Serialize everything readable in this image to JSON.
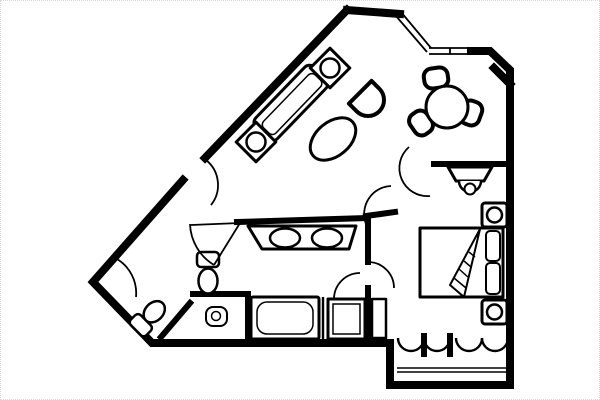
{
  "meta": {
    "title": "hotel-suite-floor-plan",
    "canvas": {
      "width": 600,
      "height": 400
    },
    "colors": {
      "background": "#ffffff",
      "ink": "#000000",
      "frame_dots": "#d8d8d8"
    }
  },
  "floorplan": {
    "walls_exterior": [
      "M 347 10 L 205 158",
      "M 183 180 L 93 282 L 152 343 L 390 343 L 390 385 L 510 385 L 510 70 L 490 51 L 471 51",
      "M 400 14 L 347 10",
      "M 494 68 L 510 84"
    ],
    "windows": [
      "M 401 12 L 431 48",
      "M 396 16 L 427 52",
      "M 429 48 L 472 48",
      "M 429 54 L 472 54",
      "M 450 48 L 450 54"
    ],
    "walls_interior": [
      "M 237 222 L 368 218 L 368 262",
      "M 366 216 L 395 212",
      "M 368 288 L 368 341",
      "M 248 295 L 248 341",
      "M 193 294 L 248 294",
      "M 190 303 L 161 337",
      "M 434 164 L 510 164",
      "M 424 336 L 424 354",
      "M 450 336 L 450 354"
    ],
    "walls_thin": [
      "M 323 297 L 323 341"
    ],
    "doors": [
      {
        "name": "entry-door-swing",
        "d": "M 206 160 A 32 32 0 0 1 211 205"
      },
      {
        "name": "bathroom-door-swing",
        "d": "M 190 224 A 50 50 0 0 0 214 265",
        "leaf": "M 240 223 L 191 225",
        "leaf2": "M 240 223 L 214 265"
      },
      {
        "name": "wc-door-swing",
        "d": "M 117 259 A 40 40 0 0 1 136 297"
      },
      {
        "name": "double-door-left-swing",
        "d": "M 366 224 A 28 28 0 0 1 391 186"
      },
      {
        "name": "double-door-right-swing",
        "d": "M 430 196 A 28 28 0 0 1 409 147"
      },
      {
        "name": "bedroom-bathroom-door-swing",
        "d": "M 368 262 A 26 26 0 0 1 394 288"
      },
      {
        "name": "shower-door-swing",
        "d": "M 334 299 A 26 26 0 0 1 360 273"
      },
      {
        "name": "closet-bifold-door-1",
        "d": "M 398 338 A 13 13 0 0 0 424 338",
        "cls": "wt"
      },
      {
        "name": "closet-bifold-door-2",
        "d": "M 424 338 A 13 13 0 0 0 450 338",
        "cls": "wt"
      },
      {
        "name": "closet-bifold-door-3",
        "d": "M 456 338 A 13 13 0 0 0 482 338",
        "cls": "wt"
      },
      {
        "name": "closet-bifold-door-4",
        "d": "M 482 338 A 13 13 0 0 0 508 338",
        "cls": "wt"
      }
    ],
    "furniture": [
      {
        "name": "sofa",
        "tf": "rotate(-46 291 103)",
        "shapes": [
          {
            "t": "rect",
            "x": 249,
            "y": 88,
            "width": 84,
            "height": 30,
            "rx": 7,
            "cls": "f3"
          },
          {
            "t": "rect",
            "x": 254,
            "y": 96,
            "width": 74,
            "height": 17,
            "rx": 5,
            "cls": "ln"
          }
        ]
      },
      {
        "name": "side-table-lamp",
        "tf": "rotate(45 330 68)",
        "shapes": [
          {
            "t": "rect",
            "x": 316,
            "y": 54,
            "width": 28,
            "height": 28,
            "cls": "f3"
          },
          {
            "t": "circle",
            "cx": 330,
            "cy": 68,
            "r": 9.5,
            "cls": "f25"
          }
        ]
      },
      {
        "name": "side-table-lamp",
        "tf": "rotate(45 256 142)",
        "shapes": [
          {
            "t": "rect",
            "x": 242,
            "y": 128,
            "width": 28,
            "height": 28,
            "cls": "f3"
          },
          {
            "t": "circle",
            "cx": 256,
            "cy": 142,
            "r": 9.5,
            "cls": "f25"
          }
        ]
      },
      {
        "name": "armchair",
        "tf": "translate(368 100) rotate(45)",
        "shapes": [
          {
            "t": "path",
            "d": "M -11 -16 L 0 -16 A 16 16 0 0 1 0 16 L -11 16 Z",
            "cls": "f4"
          }
        ]
      },
      {
        "name": "oval-table",
        "tf": "rotate(-40 333 139)",
        "shapes": [
          {
            "t": "ellipse",
            "cx": 333,
            "cy": 139,
            "rx": 26,
            "ry": 17,
            "cls": "f3"
          }
        ]
      },
      {
        "name": "dining-chair",
        "tf": "translate(436 78) rotate(-8)",
        "shapes": [
          {
            "t": "rect",
            "x": -12,
            "y": -10,
            "width": 24,
            "height": 20,
            "rx": 8,
            "cls": "f4"
          }
        ]
      },
      {
        "name": "dining-chair",
        "tf": "translate(421 123) rotate(55)",
        "shapes": [
          {
            "t": "rect",
            "x": -12,
            "y": -10,
            "width": 24,
            "height": 20,
            "rx": 8,
            "cls": "f4"
          }
        ]
      },
      {
        "name": "dining-chair",
        "tf": "translate(471 113) rotate(-70)",
        "shapes": [
          {
            "t": "rect",
            "x": -12,
            "y": -10,
            "width": 24,
            "height": 20,
            "rx": 8,
            "cls": "f4"
          }
        ]
      },
      {
        "name": "dining-table",
        "shapes": [
          {
            "t": "circle",
            "cx": 447,
            "cy": 107,
            "r": 21,
            "cls": "f3"
          }
        ]
      },
      {
        "name": "tv-stand",
        "shapes": [
          {
            "t": "polygon",
            "points": "448,167 492,167 484,181 456,181",
            "cls": "f3"
          },
          {
            "t": "path",
            "d": "M 459 181 A 11 11 0 0 0 481 181",
            "cls": "f25"
          },
          {
            "t": "circle",
            "cx": 470,
            "cy": 189,
            "r": 5.5,
            "cls": "f2"
          }
        ]
      },
      {
        "name": "vanity-double-sink",
        "shapes": [
          {
            "t": "polygon",
            "points": "248,226 356,226 349,249 262,249",
            "cls": "f3"
          },
          {
            "t": "ellipse",
            "cx": 285,
            "cy": 238,
            "rx": 15,
            "ry": 9.5,
            "cls": "f25"
          },
          {
            "t": "ellipse",
            "cx": 327,
            "cy": 238,
            "rx": 15,
            "ry": 9.5,
            "cls": "f25"
          }
        ]
      },
      {
        "name": "toilet",
        "shapes": [
          {
            "t": "rect",
            "x": 197,
            "y": 252,
            "width": 22,
            "height": 15,
            "rx": 4,
            "cls": "f25"
          },
          {
            "t": "ellipse",
            "cx": 208,
            "cy": 281,
            "rx": 9.5,
            "ry": 12.5,
            "cls": "f25"
          }
        ]
      },
      {
        "name": "wc-toilet",
        "tf": "translate(150 316) rotate(45)",
        "shapes": [
          {
            "t": "rect",
            "x": -11,
            "y": 6,
            "width": 22,
            "height": 14,
            "rx": 4,
            "cls": "f25"
          },
          {
            "t": "ellipse",
            "cx": 0,
            "cy": -6,
            "rx": 9,
            "ry": 12,
            "cls": "f25"
          }
        ]
      },
      {
        "name": "wc-sink",
        "shapes": [
          {
            "t": "rect",
            "x": 206,
            "y": 307,
            "width": 21,
            "height": 19,
            "rx": 7,
            "cls": "f2"
          },
          {
            "t": "circle",
            "cx": 216,
            "cy": 316,
            "r": 4.5,
            "cls": "ln"
          }
        ]
      },
      {
        "name": "bathtub",
        "shapes": [
          {
            "t": "rect",
            "x": 251,
            "y": 297,
            "width": 68,
            "height": 42,
            "rx": 2,
            "cls": "f3"
          },
          {
            "t": "rect",
            "x": 257,
            "y": 302,
            "width": 56,
            "height": 32,
            "rx": 10,
            "cls": "ln"
          }
        ]
      },
      {
        "name": "shower",
        "shapes": [
          {
            "t": "rect",
            "x": 328,
            "y": 299,
            "width": 37,
            "height": 40,
            "cls": "f3"
          },
          {
            "t": "rect",
            "x": 333,
            "y": 304,
            "width": 27,
            "height": 30,
            "cls": "ln"
          }
        ]
      },
      {
        "name": "linen-cabinet",
        "shapes": [
          {
            "t": "rect",
            "x": 372,
            "y": 299,
            "width": 14,
            "height": 39,
            "cls": "f25"
          }
        ]
      },
      {
        "name": "bed",
        "shapes": [
          {
            "t": "rect",
            "x": 420,
            "y": 228,
            "width": 83,
            "height": 69,
            "cls": "f3"
          },
          {
            "t": "rect",
            "x": 486,
            "y": 231,
            "width": 14,
            "height": 30,
            "rx": 4,
            "cls": "f2"
          },
          {
            "t": "rect",
            "x": 486,
            "y": 263,
            "width": 14,
            "height": 31,
            "rx": 4,
            "cls": "f2"
          },
          {
            "t": "polygon",
            "points": "480,229 464,297 450,285",
            "cls": "f2"
          },
          {
            "t": "line",
            "x1": 469,
            "y1": 252,
            "x2": 475,
            "y2": 257,
            "cls": "ln"
          },
          {
            "t": "line",
            "x1": 464,
            "y1": 261,
            "x2": 471,
            "y2": 267,
            "cls": "ln"
          },
          {
            "t": "line",
            "x1": 459,
            "y1": 269,
            "x2": 469,
            "y2": 278,
            "cls": "ln"
          },
          {
            "t": "line",
            "x1": 454,
            "y1": 278,
            "x2": 466,
            "y2": 288,
            "cls": "ln"
          }
        ]
      },
      {
        "name": "nightstand-lamp",
        "shapes": [
          {
            "t": "rect",
            "x": 482,
            "y": 203,
            "width": 25,
            "height": 24,
            "rx": 3,
            "cls": "f3"
          },
          {
            "t": "circle",
            "cx": 494.5,
            "cy": 215,
            "r": 7.5,
            "cls": "f25"
          }
        ]
      },
      {
        "name": "nightstand-lamp",
        "shapes": [
          {
            "t": "rect",
            "x": 482,
            "y": 300,
            "width": 25,
            "height": 24,
            "rx": 3,
            "cls": "f3"
          },
          {
            "t": "circle",
            "cx": 494.5,
            "cy": 312,
            "r": 7.5,
            "cls": "f25"
          }
        ]
      },
      {
        "name": "closet-rail",
        "shapes": [
          {
            "t": "line",
            "x1": 397,
            "y1": 368,
            "x2": 507,
            "y2": 368,
            "cls": "ln"
          },
          {
            "t": "line",
            "x1": 397,
            "y1": 372,
            "x2": 507,
            "y2": 372,
            "cls": "ln"
          }
        ]
      }
    ]
  }
}
